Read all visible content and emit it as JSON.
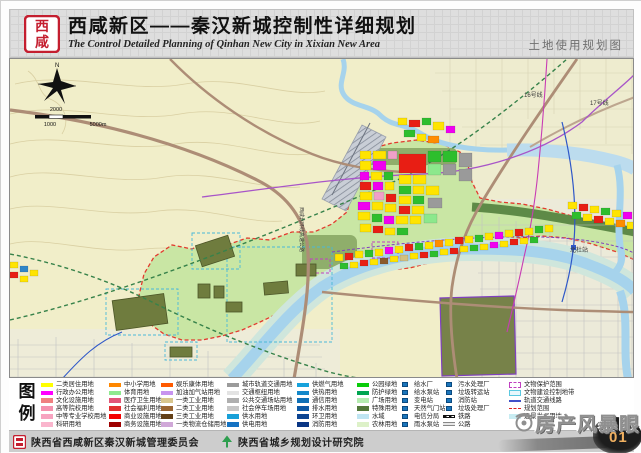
{
  "header": {
    "title": "西咸新区——秦汉新城控制性详细规划",
    "subtitle": "The Control Detailed Planning of Qinhan New City in Xixian New Area",
    "map_type_label": "土地使用规划图",
    "logo_chars": [
      "西",
      "咸"
    ]
  },
  "map": {
    "labels": [
      {
        "t": "16号线",
        "x": 514,
        "y": 38
      },
      {
        "t": "17号线",
        "x": 580,
        "y": 46
      },
      {
        "t": "北杜站",
        "x": 560,
        "y": 193
      },
      {
        "t": "西咸北环线高速公路",
        "x": 290,
        "y": 148,
        "v": 1
      }
    ],
    "scale": [
      {
        "t": "2000",
        "x": 46,
        "y": 52
      },
      {
        "t": "1000",
        "x": 40,
        "y": 67
      },
      {
        "t": "5000m",
        "x": 88,
        "y": 67
      }
    ],
    "palette": [
      "#FFE400",
      "#E81E14",
      "#2DBE2D",
      "#F000F0",
      "#FF8C00",
      "#9A9A9A",
      "#2E86C8",
      "#8B5A2B",
      "#F0A0C8",
      "#8CE88C",
      "#D2C080",
      "#1B75BB"
    ],
    "blocks": [
      [
        350,
        92,
        11,
        8,
        0
      ],
      [
        363,
        92,
        13,
        8,
        0
      ],
      [
        378,
        92,
        9,
        8,
        8
      ],
      [
        389,
        95,
        27,
        19,
        1
      ],
      [
        418,
        92,
        13,
        11,
        2
      ],
      [
        433,
        92,
        14,
        11,
        2
      ],
      [
        449,
        94,
        13,
        14,
        5
      ],
      [
        350,
        102,
        11,
        9,
        0
      ],
      [
        363,
        102,
        13,
        9,
        3
      ],
      [
        350,
        113,
        9,
        8,
        3
      ],
      [
        361,
        113,
        11,
        8,
        0
      ],
      [
        374,
        113,
        9,
        8,
        2
      ],
      [
        389,
        116,
        12,
        9,
        0
      ],
      [
        403,
        116,
        13,
        9,
        0
      ],
      [
        418,
        105,
        13,
        11,
        9
      ],
      [
        433,
        105,
        13,
        11,
        5
      ],
      [
        449,
        110,
        13,
        12,
        5
      ],
      [
        350,
        123,
        11,
        8,
        1
      ],
      [
        363,
        123,
        10,
        8,
        3
      ],
      [
        375,
        123,
        9,
        8,
        0
      ],
      [
        389,
        127,
        12,
        8,
        2
      ],
      [
        403,
        127,
        11,
        8,
        0
      ],
      [
        416,
        127,
        13,
        9,
        0
      ],
      [
        350,
        133,
        12,
        8,
        0
      ],
      [
        364,
        133,
        10,
        8,
        8
      ],
      [
        376,
        135,
        10,
        8,
        1
      ],
      [
        389,
        137,
        12,
        8,
        0
      ],
      [
        403,
        137,
        11,
        8,
        2
      ],
      [
        418,
        139,
        14,
        10,
        5
      ],
      [
        348,
        143,
        12,
        8,
        3
      ],
      [
        362,
        143,
        11,
        8,
        0
      ],
      [
        375,
        145,
        11,
        8,
        0
      ],
      [
        389,
        147,
        11,
        8,
        1
      ],
      [
        402,
        147,
        12,
        8,
        0
      ],
      [
        348,
        153,
        12,
        8,
        0
      ],
      [
        362,
        155,
        10,
        8,
        2
      ],
      [
        374,
        157,
        10,
        8,
        3
      ],
      [
        386,
        157,
        12,
        8,
        0
      ],
      [
        400,
        157,
        11,
        8,
        0
      ],
      [
        414,
        155,
        13,
        9,
        9
      ],
      [
        350,
        165,
        11,
        8,
        0
      ],
      [
        363,
        167,
        10,
        7,
        1
      ],
      [
        375,
        169,
        10,
        7,
        0
      ],
      [
        387,
        169,
        11,
        7,
        2
      ],
      [
        388,
        59,
        9,
        7,
        0
      ],
      [
        399,
        61,
        11,
        7,
        1
      ],
      [
        412,
        59,
        9,
        7,
        2
      ],
      [
        423,
        63,
        11,
        8,
        0
      ],
      [
        436,
        67,
        9,
        7,
        3
      ],
      [
        394,
        71,
        11,
        7,
        2
      ],
      [
        407,
        75,
        9,
        7,
        0
      ],
      [
        418,
        77,
        11,
        7,
        4
      ],
      [
        325,
        195,
        8,
        7,
        0
      ],
      [
        335,
        194,
        8,
        7,
        1
      ],
      [
        345,
        192,
        8,
        7,
        0
      ],
      [
        355,
        191,
        8,
        7,
        2
      ],
      [
        365,
        190,
        8,
        7,
        0
      ],
      [
        375,
        188,
        8,
        7,
        3
      ],
      [
        385,
        187,
        8,
        7,
        0
      ],
      [
        395,
        185,
        8,
        7,
        1
      ],
      [
        405,
        184,
        8,
        7,
        2
      ],
      [
        415,
        183,
        8,
        7,
        0
      ],
      [
        425,
        181,
        8,
        7,
        4
      ],
      [
        435,
        180,
        8,
        7,
        0
      ],
      [
        445,
        178,
        8,
        7,
        1
      ],
      [
        455,
        177,
        8,
        7,
        0
      ],
      [
        465,
        176,
        8,
        7,
        2
      ],
      [
        475,
        174,
        8,
        7,
        0
      ],
      [
        485,
        173,
        8,
        7,
        3
      ],
      [
        495,
        171,
        8,
        7,
        0
      ],
      [
        505,
        170,
        8,
        7,
        1
      ],
      [
        515,
        169,
        8,
        7,
        0
      ],
      [
        525,
        167,
        8,
        7,
        2
      ],
      [
        535,
        166,
        8,
        7,
        0
      ],
      [
        330,
        204,
        8,
        6,
        2
      ],
      [
        340,
        203,
        8,
        6,
        0
      ],
      [
        350,
        201,
        8,
        6,
        1
      ],
      [
        360,
        200,
        8,
        6,
        0
      ],
      [
        370,
        199,
        8,
        6,
        7
      ],
      [
        380,
        197,
        8,
        6,
        0
      ],
      [
        390,
        196,
        8,
        6,
        10
      ],
      [
        400,
        194,
        8,
        6,
        0
      ],
      [
        410,
        193,
        8,
        6,
        1
      ],
      [
        420,
        192,
        8,
        6,
        2
      ],
      [
        430,
        190,
        8,
        6,
        0
      ],
      [
        440,
        189,
        8,
        6,
        1
      ],
      [
        450,
        187,
        8,
        6,
        0
      ],
      [
        460,
        186,
        8,
        6,
        2
      ],
      [
        470,
        185,
        8,
        6,
        0
      ],
      [
        480,
        183,
        8,
        6,
        3
      ],
      [
        490,
        182,
        8,
        6,
        0
      ],
      [
        500,
        180,
        8,
        6,
        1
      ],
      [
        510,
        179,
        8,
        6,
        0
      ],
      [
        520,
        178,
        8,
        6,
        2
      ],
      [
        558,
        143,
        9,
        7,
        0
      ],
      [
        569,
        145,
        9,
        7,
        1
      ],
      [
        580,
        147,
        9,
        7,
        0
      ],
      [
        591,
        149,
        9,
        7,
        2
      ],
      [
        602,
        151,
        9,
        7,
        0
      ],
      [
        613,
        153,
        9,
        7,
        3
      ],
      [
        562,
        153,
        9,
        7,
        2
      ],
      [
        573,
        155,
        9,
        7,
        0
      ],
      [
        584,
        157,
        9,
        7,
        1
      ],
      [
        595,
        159,
        9,
        7,
        0
      ],
      [
        606,
        161,
        9,
        7,
        4
      ],
      [
        617,
        163,
        9,
        7,
        0
      ],
      [
        0,
        203,
        8,
        6,
        0
      ],
      [
        10,
        207,
        8,
        6,
        6
      ],
      [
        0,
        213,
        8,
        6,
        1
      ],
      [
        20,
        211,
        8,
        6,
        0
      ],
      [
        10,
        217,
        8,
        6,
        0
      ]
    ],
    "olive_patches": [
      [
        104,
        238,
        52,
        30,
        -8
      ],
      [
        188,
        181,
        34,
        22,
        -18
      ],
      [
        188,
        225,
        12,
        14,
        0
      ],
      [
        204,
        227,
        10,
        12,
        0
      ],
      [
        216,
        243,
        16,
        10,
        0
      ],
      [
        254,
        223,
        24,
        12,
        -5
      ],
      [
        286,
        205,
        20,
        12,
        0
      ],
      [
        160,
        288,
        22,
        10,
        0
      ]
    ],
    "cyan_zones": [
      [
        96,
        230,
        72,
        46
      ],
      [
        182,
        174,
        48,
        36
      ],
      [
        217,
        188,
        105,
        95
      ],
      [
        155,
        283,
        32,
        18
      ]
    ],
    "purple_zones": [
      [
        362,
        183,
        26,
        16
      ],
      [
        300,
        200,
        20,
        14
      ]
    ]
  },
  "legend": {
    "title_chars": [
      "图",
      "例"
    ],
    "columns": [
      {
        "x": 32,
        "items": [
          {
            "label": "二类居住用地",
            "type": "fill",
            "color": "#FFFF00"
          },
          {
            "label": "行政办公用地",
            "type": "fill",
            "color": "#FF00FF"
          },
          {
            "label": "文化设施用地",
            "type": "fill",
            "color": "#EF8080"
          },
          {
            "label": "高等院校用地",
            "type": "fill",
            "color": "#F492AE"
          },
          {
            "label": "中等专业学校用地",
            "type": "fill",
            "color": "#F7A3C0"
          },
          {
            "label": "科研用地",
            "type": "fill",
            "color": "#FAB5CD"
          }
        ]
      },
      {
        "x": 100,
        "items": [
          {
            "label": "中小学用地",
            "type": "fill",
            "color": "#FF8700"
          },
          {
            "label": "体育用地",
            "type": "fill",
            "color": "#8FE98F"
          },
          {
            "label": "医疗卫生用地",
            "type": "fill",
            "color": "#E25578"
          },
          {
            "label": "社会福利用地",
            "type": "fill",
            "color": "#E03030"
          },
          {
            "label": "商业设施用地",
            "type": "fill",
            "color": "#F40000"
          },
          {
            "label": "商务设施用地",
            "type": "fill",
            "color": "#9E0000"
          }
        ]
      },
      {
        "x": 152,
        "items": [
          {
            "label": "娱乐康体用地",
            "type": "fill",
            "color": "#FF5A00"
          },
          {
            "label": "加油加气站用地",
            "type": "fill",
            "color": "#C894F0"
          },
          {
            "label": "一类工业用地",
            "type": "fill",
            "color": "#D8C68E"
          },
          {
            "label": "二类工业用地",
            "type": "fill",
            "color": "#9A6633"
          },
          {
            "label": "三类工业用地",
            "type": "fill",
            "color": "#633F17"
          },
          {
            "label": "一类物流仓储用地",
            "type": "fill",
            "color": "#D0A8D8"
          }
        ]
      },
      {
        "x": 218,
        "items": [
          {
            "label": "城市轨道交通用地",
            "type": "fill",
            "color": "#9B9B9B"
          },
          {
            "label": "交通枢纽用地",
            "type": "fill",
            "color": "#E3E3E3"
          },
          {
            "label": "公共交通场站用地",
            "type": "fill",
            "color": "#AFAFAF"
          },
          {
            "label": "社会停车场用地",
            "type": "fill",
            "color": "#C6C6C6"
          },
          {
            "label": "供水用地",
            "type": "fill",
            "color": "#18A0D8"
          },
          {
            "label": "供电用地",
            "type": "fill",
            "color": "#1472C2"
          }
        ]
      },
      {
        "x": 288,
        "items": [
          {
            "label": "供燃气用地",
            "type": "fill",
            "color": "#17A2DC"
          },
          {
            "label": "供热用地",
            "type": "fill",
            "color": "#1488CA"
          },
          {
            "label": "通信用地",
            "type": "fill",
            "color": "#1070B6"
          },
          {
            "label": "排水用地",
            "type": "fill",
            "color": "#0D58A4"
          },
          {
            "label": "环卫用地",
            "type": "fill",
            "color": "#0B4492"
          },
          {
            "label": "消防用地",
            "type": "fill",
            "color": "#0A3684"
          }
        ]
      },
      {
        "x": 348,
        "items": [
          {
            "label": "公园绿地",
            "type": "fill",
            "color": "#0ACC0A"
          },
          {
            "label": "防护绿地",
            "type": "fill",
            "color": "#00A551"
          },
          {
            "label": "广场用地",
            "type": "fill",
            "color": "#B5ECB0"
          },
          {
            "label": "特殊用地",
            "type": "fill",
            "color": "#52783A"
          },
          {
            "label": "水域",
            "type": "fill",
            "color": "#BFE5F2"
          },
          {
            "label": "农林用地",
            "type": "fill",
            "color": "#DDF1C8"
          }
        ]
      },
      {
        "x": 390,
        "items": [
          {
            "label": "给水厂",
            "type": "icon"
          },
          {
            "label": "给水泵站",
            "type": "icon"
          },
          {
            "label": "变电站",
            "type": "icon"
          },
          {
            "label": "天然气门站",
            "type": "icon"
          },
          {
            "label": "电信分局",
            "type": "icon"
          },
          {
            "label": "雨水泵站",
            "type": "icon"
          }
        ]
      },
      {
        "x": 434,
        "items": [
          {
            "label": "污水处理厂",
            "type": "icon"
          },
          {
            "label": "垃圾转运站",
            "type": "icon"
          },
          {
            "label": "消防站",
            "type": "icon"
          },
          {
            "label": "垃圾处理厂",
            "type": "icon"
          },
          {
            "label": "铁路",
            "type": "rail"
          },
          {
            "label": "公路",
            "type": "road"
          }
        ]
      },
      {
        "x": 500,
        "items": [
          {
            "label": "文物保护范围",
            "type": "dashrect"
          },
          {
            "label": "文物建设控制地带",
            "type": "cyanrect"
          },
          {
            "label": "轨道交通线路",
            "type": "line",
            "color": "#4050C8"
          },
          {
            "label": "规划范围",
            "type": "reddash"
          },
          {
            "label": "远景发展用地",
            "type": "fill",
            "color": "#C8ECF2"
          }
        ]
      }
    ]
  },
  "footer": {
    "org1": "陕西省西咸新区秦汉新城管理委员会",
    "org2": "陕西省城乡规划设计研究院",
    "page_number": "01"
  },
  "watermark": {
    "text": "房产风暴眼"
  }
}
